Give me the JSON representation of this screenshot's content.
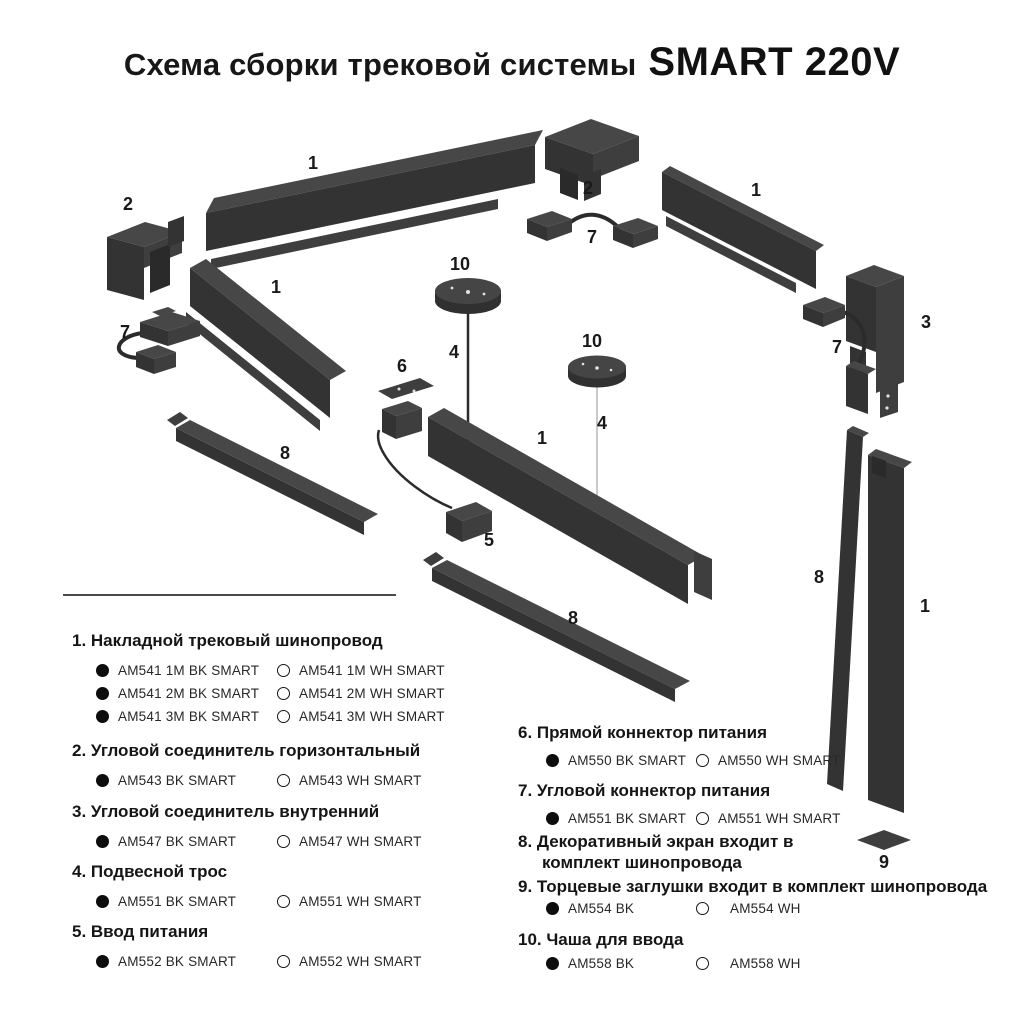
{
  "title": {
    "prefix": "Схема сборки трековой системы",
    "brand": "SMART 220V"
  },
  "colors": {
    "background": "#ffffff",
    "text": "#1a1a1a",
    "part_top": "#474747",
    "part_front": "#333333",
    "part_side": "#3e3e3e",
    "wire_dark": "#2b2b2b",
    "wire_light": "#c4c4c4",
    "bullet_black": "#0d0d0d"
  },
  "diagram": {
    "labels": [
      "1",
      "2",
      "2",
      "7",
      "1",
      "3",
      "7",
      "10",
      "4",
      "10",
      "4",
      "6",
      "1",
      "7",
      "1",
      "5",
      "8",
      "8",
      "8",
      "1",
      "9"
    ]
  },
  "legend": {
    "items": [
      {
        "heading": "1. Накладной трековый шинопровод",
        "variants": [
          {
            "bk": "AM541 1M BK SMART",
            "wh": "AM541 1M WH SMART"
          },
          {
            "bk": "AM541 2M BK SMART",
            "wh": "AM541 2M WH SMART"
          },
          {
            "bk": "AM541 3M BK SMART",
            "wh": "AM541 3M WH SMART"
          }
        ]
      },
      {
        "heading": "2. Угловой соединитель горизонтальный",
        "variants": [
          {
            "bk": "AM543 BK SMART",
            "wh": "AM543 WH SMART"
          }
        ]
      },
      {
        "heading": "3. Угловой соединитель внутренний",
        "variants": [
          {
            "bk": "AM547 BK SMART",
            "wh": "AM547 WH SMART"
          }
        ]
      },
      {
        "heading": "4. Подвесной трос",
        "variants": [
          {
            "bk": "AM551 BK SMART",
            "wh": "AM551 WH SMART"
          }
        ]
      },
      {
        "heading": "5. Ввод питания",
        "variants": [
          {
            "bk": "AM552 BK SMART",
            "wh": "AM552 WH SMART"
          }
        ]
      },
      {
        "heading": "6. Прямой коннектор питания",
        "variants": [
          {
            "bk": "AM550 BK SMART",
            "wh": "AM550 WH SMART"
          }
        ]
      },
      {
        "heading": "7. Угловой коннектор питания",
        "variants": [
          {
            "bk": "AM551 BK SMART",
            "wh": "AM551 WH SMART"
          }
        ]
      },
      {
        "heading": "8. Декоративный экран входит в",
        "heading2": "комплект шинопровода",
        "variants": []
      },
      {
        "heading": "9. Торцевые заглушки входит в комплект шинопровода",
        "variants": [
          {
            "bk": "AM554 BK",
            "wh": "AM554 WH"
          }
        ]
      },
      {
        "heading": "10. Чаша для ввода",
        "variants": [
          {
            "bk": "AM558 BK",
            "wh": "AM558 WH"
          }
        ]
      }
    ]
  }
}
